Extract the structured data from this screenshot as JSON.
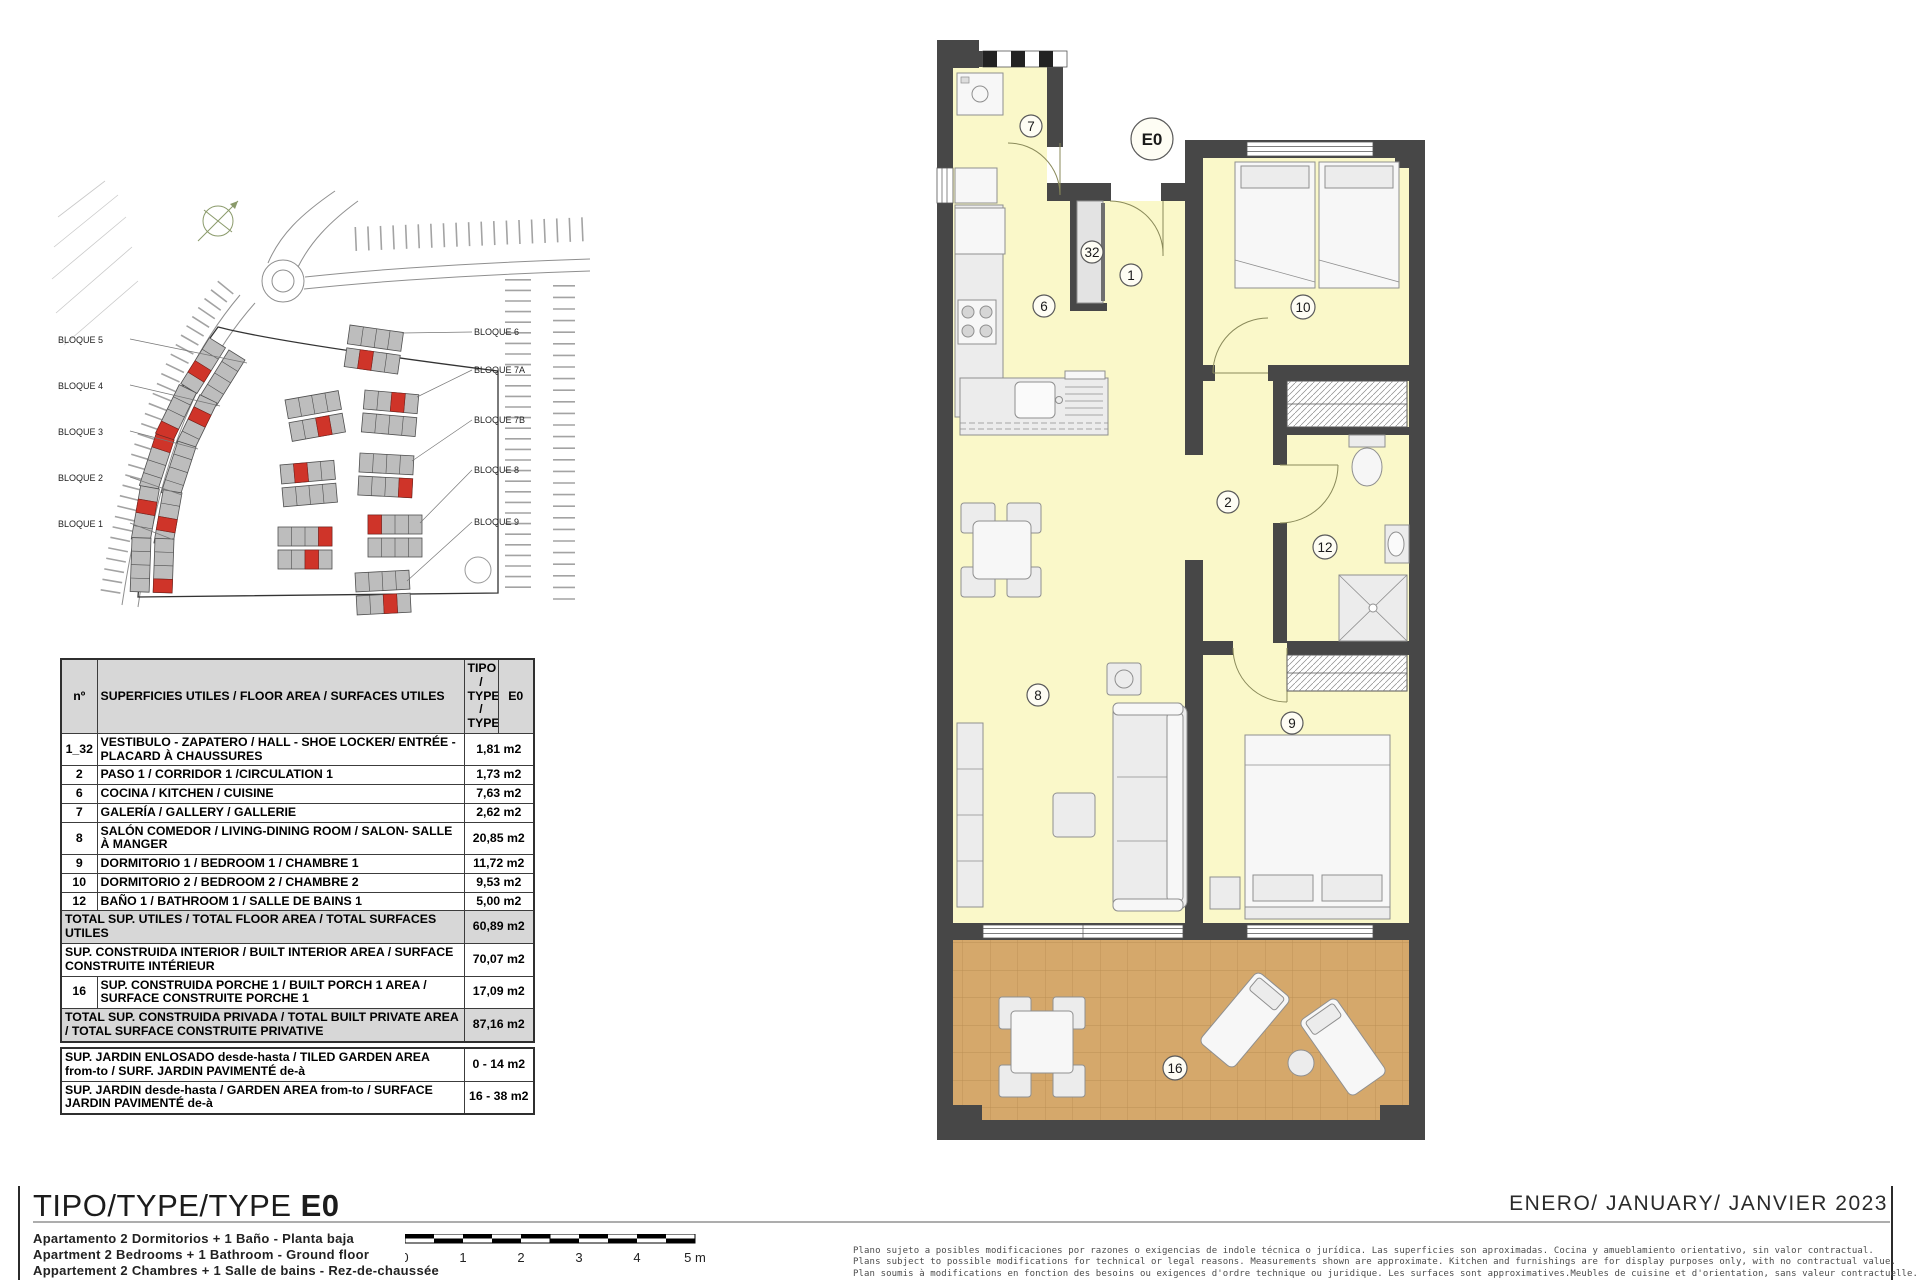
{
  "colors": {
    "accent_red": "#cf3429",
    "wall": "#474747",
    "room_fill": "#faf8c9",
    "terrace_fill": "#d5a86b"
  },
  "site_plan": {
    "labels_left": [
      "BLOQUE 5",
      "BLOQUE 4",
      "BLOQUE 3",
      "BLOQUE 2",
      "BLOQUE 1"
    ],
    "labels_right": [
      "BLOQUE 6",
      "BLOQUE 7A",
      "BLOQUE 7B",
      "BLOQUE 8",
      "BLOQUE 9"
    ]
  },
  "area_table": {
    "header": {
      "num": "nº",
      "desc": "SUPERFICIES UTILES / FLOOR AREA / SURFACES UTILES",
      "type_label": "TIPO / TYPE / TYPE",
      "type_value": "E0"
    },
    "rows": [
      {
        "num": "1_32",
        "desc": "VESTIBULO - ZAPATERO / HALL - SHOE LOCKER/ ENTRÉE - PLACARD À CHAUSSURES",
        "value": "1,81 m2",
        "shade": false,
        "full": false
      },
      {
        "num": "2",
        "desc": "PASO 1 / CORRIDOR 1 /CIRCULATION 1",
        "value": "1,73 m2",
        "shade": false,
        "full": false
      },
      {
        "num": "6",
        "desc": "COCINA / KITCHEN / CUISINE",
        "value": "7,63 m2",
        "shade": false,
        "full": false
      },
      {
        "num": "7",
        "desc": "GALERÍA / GALLERY / GALLERIE",
        "value": "2,62 m2",
        "shade": false,
        "full": false
      },
      {
        "num": "8",
        "desc": "SALÓN COMEDOR  / LIVING-DINING ROOM / SALON- SALLE À MANGER",
        "value": "20,85 m2",
        "shade": false,
        "full": false
      },
      {
        "num": "9",
        "desc": "DORMITORIO 1 / BEDROOM 1 / CHAMBRE 1",
        "value": "11,72 m2",
        "shade": false,
        "full": false
      },
      {
        "num": "10",
        "desc": "DORMITORIO 2 / BEDROOM 2 / CHAMBRE 2",
        "value": "9,53 m2",
        "shade": false,
        "full": false
      },
      {
        "num": "12",
        "desc": "BAÑO 1 / BATHROOM 1 / SALLE DE BAINS 1",
        "value": "5,00 m2",
        "shade": false,
        "full": false
      },
      {
        "num": "",
        "desc": "TOTAL SUP. UTILES / TOTAL FLOOR AREA / TOTAL SURFACES UTILES",
        "value": "60,89 m2",
        "shade": true,
        "full": true
      },
      {
        "num": "",
        "desc": "SUP. CONSTRUIDA INTERIOR / BUILT INTERIOR AREA / SURFACE CONSTRUITE INTÉRIEUR",
        "value": "70,07 m2",
        "shade": false,
        "full": true
      },
      {
        "num": "16",
        "desc": "SUP. CONSTRUIDA PORCHE 1 / BUILT PORCH 1 AREA / SURFACE CONSTRUITE PORCHE 1",
        "value": "17,09 m2",
        "shade": false,
        "full": false
      },
      {
        "num": "",
        "desc": "TOTAL SUP. CONSTRUIDA PRIVADA / TOTAL  BUILT PRIVATE AREA / TOTAL SURFACE CONSTRUITE PRIVATIVE",
        "value": "87,16 m2",
        "shade": true,
        "full": true
      }
    ]
  },
  "garden_table": {
    "rows": [
      {
        "desc": "SUP. JARDIN ENLOSADO desde-hasta / TILED GARDEN AREA from-to / SURF. JARDIN  PAVIMENTÉ de-à",
        "value": "0 - 14 m2"
      },
      {
        "desc": "SUP. JARDIN desde-hasta / GARDEN AREA from-to / SURFACE JARDIN PAVIMENTÉ de-à",
        "value": "16 - 38 m2"
      }
    ]
  },
  "floor_plan": {
    "unit_label": "E0",
    "room_numbers": {
      "gallery": "7",
      "shoe_locker": "32",
      "hall": "1",
      "kitchen": "6",
      "corridor": "2",
      "bedroom2": "10",
      "bathroom": "12",
      "living": "8",
      "bedroom1": "9",
      "porch": "16"
    }
  },
  "footer": {
    "title_prefix": "TIPO/TYPE/TYPE ",
    "title_type": "E0",
    "subtitle_lines": [
      "Apartamento 2 Dormitorios + 1 Baño - Planta baja",
      "Apartment 2 Bedrooms + 1 Bathroom - Ground floor",
      "Appartement 2 Chambres + 1 Salle de bains - Rez-de-chaussée"
    ],
    "date": "ENERO/ JANUARY/ JANVIER  2023",
    "scale_ticks": [
      "0",
      "1",
      "2",
      "3",
      "4",
      "5 m"
    ],
    "disclaimer_lines": [
      "Plano sujeto a posibles modificaciones por razones o exigencias de indole técnica o jurídica. Las superficies son aproximadas. Cocina y amueblamiento orientativo, sin valor contractual.",
      "Plans subject to possible modifications for technical or legal reasons. Measurements shown are approximate. Kitchen and furnishings are for display purposes only, with no contractual value.",
      "Plan soumis à modifications en fonction des besoins ou exigences d'ordre technique ou juridique. Les surfaces sont approximatives.Meubles de cuisine et d'orientation, sans valeur contractuelle."
    ]
  }
}
